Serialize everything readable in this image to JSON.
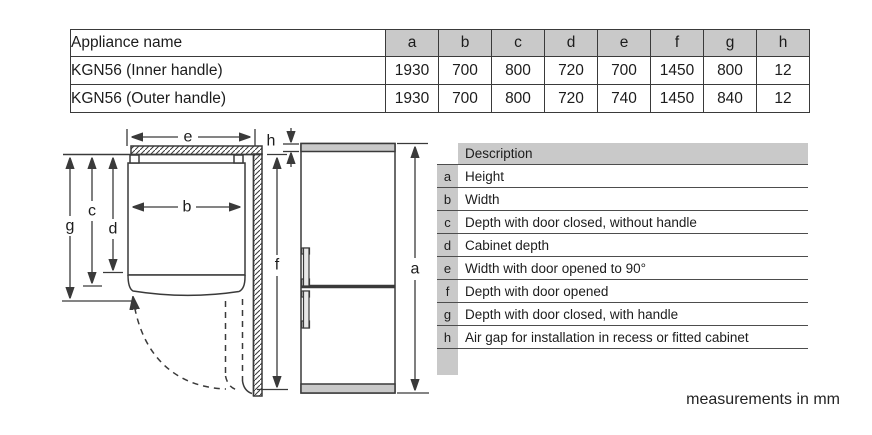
{
  "colors": {
    "header_fill": "#c9c9c9",
    "line": "#3a3a3a",
    "text": "#1c1c1c"
  },
  "spec_table": {
    "columns": [
      "Appliance name",
      "a",
      "b",
      "c",
      "d",
      "e",
      "f",
      "g",
      "h"
    ],
    "rows": [
      {
        "name": "KGN56 (Inner handle)",
        "values": [
          "1930",
          "700",
          "800",
          "720",
          "700",
          "1450",
          "800",
          "12"
        ]
      },
      {
        "name": "KGN56 (Outer handle)",
        "values": [
          "1930",
          "700",
          "800",
          "720",
          "740",
          "1450",
          "840",
          "12"
        ]
      }
    ]
  },
  "legend_table": {
    "header_label": "Description",
    "rows": [
      {
        "key": "a",
        "label": "Height"
      },
      {
        "key": "b",
        "label": "Width"
      },
      {
        "key": "c",
        "label": "Depth with door closed, without handle"
      },
      {
        "key": "d",
        "label": "Cabinet depth"
      },
      {
        "key": "e",
        "label": "Width with door opened to 90°"
      },
      {
        "key": "f",
        "label": "Depth with door opened"
      },
      {
        "key": "g",
        "label": "Depth with door closed, with handle"
      },
      {
        "key": "h",
        "label": "Air gap for installation in recess or fitted cabinet"
      }
    ]
  },
  "diagram": {
    "labels": {
      "a": "a",
      "b": "b",
      "c": "c",
      "d": "d",
      "e": "e",
      "f": "f",
      "g": "g",
      "h": "h"
    }
  },
  "footnote": "measurements in mm"
}
